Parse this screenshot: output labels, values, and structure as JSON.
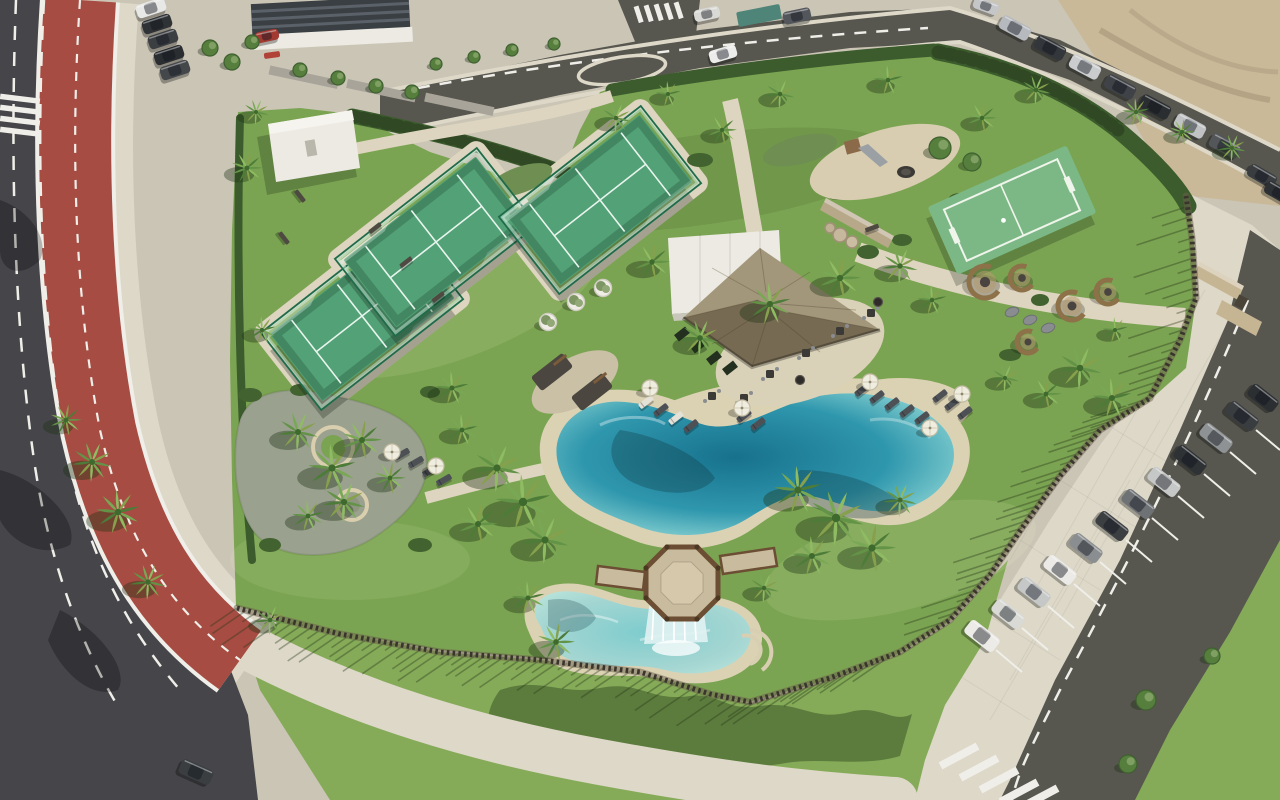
{
  "meta": {
    "kind": "aerial-photograph",
    "subject": "resort amenity park with lagoon pool, padel courts and parking",
    "width": 1280,
    "height": 800
  },
  "colors": {
    "pave": "#cbc5b6",
    "paveLight": "#ddd8c8",
    "path": "#ddd5bf",
    "asphaltDark": "#45454a",
    "asphaltMid": "#57564f",
    "bikeRed": "#a64c42",
    "laneWhite": "#efeee8",
    "grass": "#7ba452",
    "grassOuter": "#85ab58",
    "grassLight": "#a3bf6d",
    "grassDark": "#4c7034",
    "hedge": "#3c5c2d",
    "canopy": "#567f3e",
    "courtTurf": "#53a176",
    "courtWall": "#bfe2cd",
    "courtFrame": "#1f6b4a",
    "courtLine": "#e8f5ee",
    "miniTurf": "#7cb885",
    "poolDeep": "#17718d",
    "poolMid": "#2f97ad",
    "poolLight": "#7fccce",
    "poolPale": "#b7e3da",
    "kidsWater": "#a5d6d2",
    "sand": "#dbd2b4",
    "sandLot": "#c9b999",
    "thatch": "#94886b",
    "thatchDark": "#6e6450",
    "white": "#eceae2",
    "deck": "#c9bb9d",
    "wood": "#8a6c4c",
    "woodDark": "#6b4e33",
    "fencePost": "#3a352c",
    "stone": "#b7a88a",
    "wicker": "#8d7148",
    "shadow": "rgba(30,50,20,0.38)",
    "waterShadow": "rgba(15,55,65,0.32)"
  },
  "scene": {
    "palms": [
      {
        "x": 497,
        "y": 468,
        "r": 24,
        "v": 1
      },
      {
        "x": 523,
        "y": 502,
        "r": 28,
        "v": 2
      },
      {
        "x": 478,
        "y": 524,
        "r": 20,
        "v": 3
      },
      {
        "x": 545,
        "y": 540,
        "r": 24,
        "v": 1
      },
      {
        "x": 462,
        "y": 430,
        "r": 16,
        "v": 2
      },
      {
        "x": 798,
        "y": 490,
        "r": 24,
        "v": 2
      },
      {
        "x": 836,
        "y": 518,
        "r": 28,
        "v": 1
      },
      {
        "x": 872,
        "y": 548,
        "r": 24,
        "v": 3
      },
      {
        "x": 812,
        "y": 556,
        "r": 20,
        "v": 2
      },
      {
        "x": 900,
        "y": 500,
        "r": 17,
        "v": 1
      },
      {
        "x": 528,
        "y": 598,
        "r": 17,
        "v": 2
      },
      {
        "x": 556,
        "y": 642,
        "r": 19,
        "v": 3
      },
      {
        "x": 764,
        "y": 588,
        "r": 15,
        "v": 1
      },
      {
        "x": 298,
        "y": 432,
        "r": 20,
        "v": 1
      },
      {
        "x": 332,
        "y": 468,
        "r": 24,
        "v": 2
      },
      {
        "x": 362,
        "y": 440,
        "r": 20,
        "v": 3
      },
      {
        "x": 344,
        "y": 502,
        "r": 21,
        "v": 1
      },
      {
        "x": 308,
        "y": 516,
        "r": 16,
        "v": 2
      },
      {
        "x": 390,
        "y": 478,
        "r": 16,
        "v": 3
      },
      {
        "x": 92,
        "y": 462,
        "r": 20,
        "v": 1
      },
      {
        "x": 118,
        "y": 512,
        "r": 22,
        "v": 2
      },
      {
        "x": 66,
        "y": 420,
        "r": 16,
        "v": 3
      },
      {
        "x": 148,
        "y": 582,
        "r": 18,
        "v": 1
      },
      {
        "x": 262,
        "y": 330,
        "r": 14,
        "v": 2
      },
      {
        "x": 270,
        "y": 620,
        "r": 15,
        "v": 1
      },
      {
        "x": 247,
        "y": 168,
        "r": 16,
        "v": 3
      },
      {
        "x": 256,
        "y": 112,
        "r": 13,
        "v": 1
      },
      {
        "x": 452,
        "y": 388,
        "r": 17,
        "v": 2
      },
      {
        "x": 700,
        "y": 338,
        "r": 19,
        "v": 1
      },
      {
        "x": 770,
        "y": 304,
        "r": 21,
        "v": 2
      },
      {
        "x": 840,
        "y": 278,
        "r": 21,
        "v": 3
      },
      {
        "x": 900,
        "y": 266,
        "r": 18,
        "v": 1
      },
      {
        "x": 932,
        "y": 300,
        "r": 15,
        "v": 2
      },
      {
        "x": 652,
        "y": 262,
        "r": 18,
        "v": 3
      },
      {
        "x": 616,
        "y": 118,
        "r": 15,
        "v": 1
      },
      {
        "x": 668,
        "y": 94,
        "r": 13,
        "v": 2
      },
      {
        "x": 722,
        "y": 130,
        "r": 15,
        "v": 3
      },
      {
        "x": 780,
        "y": 94,
        "r": 15,
        "v": 1
      },
      {
        "x": 888,
        "y": 80,
        "r": 15,
        "v": 2
      },
      {
        "x": 982,
        "y": 118,
        "r": 15,
        "v": 3
      },
      {
        "x": 1036,
        "y": 90,
        "r": 15,
        "v": 1
      },
      {
        "x": 1136,
        "y": 112,
        "r": 14,
        "v": 2
      },
      {
        "x": 1182,
        "y": 132,
        "r": 13,
        "v": 3
      },
      {
        "x": 1232,
        "y": 148,
        "r": 14,
        "v": 1
      },
      {
        "x": 1080,
        "y": 368,
        "r": 22,
        "v": 1
      },
      {
        "x": 1112,
        "y": 398,
        "r": 20,
        "v": 2
      },
      {
        "x": 1046,
        "y": 394,
        "r": 16,
        "v": 3
      },
      {
        "x": 1005,
        "y": 378,
        "r": 14,
        "v": 1
      },
      {
        "x": 1115,
        "y": 330,
        "r": 13,
        "v": 2
      }
    ],
    "trees": [
      {
        "x": 210,
        "y": 48,
        "r": 8
      },
      {
        "x": 232,
        "y": 62,
        "r": 8
      },
      {
        "x": 252,
        "y": 42,
        "r": 7
      },
      {
        "x": 300,
        "y": 70,
        "r": 7
      },
      {
        "x": 338,
        "y": 78,
        "r": 7
      },
      {
        "x": 376,
        "y": 86,
        "r": 7
      },
      {
        "x": 412,
        "y": 92,
        "r": 7
      },
      {
        "x": 436,
        "y": 64,
        "r": 6
      },
      {
        "x": 474,
        "y": 57,
        "r": 6
      },
      {
        "x": 512,
        "y": 50,
        "r": 6
      },
      {
        "x": 554,
        "y": 44,
        "r": 6
      },
      {
        "x": 940,
        "y": 148,
        "r": 11
      },
      {
        "x": 972,
        "y": 162,
        "r": 9
      },
      {
        "x": 1146,
        "y": 700,
        "r": 10
      },
      {
        "x": 1128,
        "y": 764,
        "r": 9
      },
      {
        "x": 1212,
        "y": 656,
        "r": 8
      }
    ],
    "cars": [
      {
        "x": 151,
        "y": 8,
        "a": -18,
        "c": "#e8e8e6",
        "s": 30
      },
      {
        "x": 157,
        "y": 24,
        "a": -18,
        "c": "#303336",
        "s": 30
      },
      {
        "x": 163,
        "y": 39,
        "a": -18,
        "c": "#3c3f42",
        "s": 30
      },
      {
        "x": 169,
        "y": 55,
        "a": -18,
        "c": "#2b2e31",
        "s": 30
      },
      {
        "x": 175,
        "y": 70,
        "a": -18,
        "c": "#45484b",
        "s": 30
      },
      {
        "x": 267,
        "y": 36,
        "a": -12,
        "c": "#a33a32",
        "s": 24
      },
      {
        "x": 707,
        "y": 14,
        "a": -12,
        "c": "#d9d9d6",
        "s": 26
      },
      {
        "x": 723,
        "y": 54,
        "a": -16,
        "c": "#ececea",
        "s": 28
      },
      {
        "x": 797,
        "y": 16,
        "a": -12,
        "c": "#53565a",
        "s": 28
      },
      {
        "x": 986,
        "y": 6,
        "a": 20,
        "c": "#c4c6c8",
        "s": 26
      },
      {
        "x": 1015,
        "y": 28,
        "a": 28,
        "c": "#b6b9bd",
        "s": 32
      },
      {
        "x": 1050,
        "y": 48,
        "a": 28,
        "c": "#33363a",
        "s": 32
      },
      {
        "x": 1085,
        "y": 67,
        "a": 28,
        "c": "#caccce",
        "s": 32
      },
      {
        "x": 1120,
        "y": 87,
        "a": 28,
        "c": "#3f4246",
        "s": 32
      },
      {
        "x": 1155,
        "y": 107,
        "a": 28,
        "c": "#2b2e31",
        "s": 32
      },
      {
        "x": 1190,
        "y": 126,
        "a": 28,
        "c": "#c0c2c4",
        "s": 32
      },
      {
        "x": 1225,
        "y": 146,
        "a": 28,
        "c": "#54575a",
        "s": 32
      },
      {
        "x": 1262,
        "y": 176,
        "a": 30,
        "c": "#3a3d40",
        "s": 30
      },
      {
        "x": 1279,
        "y": 193,
        "a": 30,
        "c": "#2e3134",
        "s": 30
      },
      {
        "x": 982,
        "y": 636,
        "a": 38,
        "c": "#edebe7",
        "s": 36
      },
      {
        "x": 1008,
        "y": 614,
        "a": 38,
        "c": "#d9dad6",
        "s": 34
      },
      {
        "x": 1034,
        "y": 592,
        "a": 38,
        "c": "#c6c8c8",
        "s": 34
      },
      {
        "x": 1060,
        "y": 570,
        "a": 38,
        "c": "#eceae6",
        "s": 34
      },
      {
        "x": 1086,
        "y": 548,
        "a": 38,
        "c": "#8b8e90",
        "s": 34
      },
      {
        "x": 1112,
        "y": 526,
        "a": 38,
        "c": "#3c3f42",
        "s": 34
      },
      {
        "x": 1138,
        "y": 504,
        "a": 38,
        "c": "#6f7275",
        "s": 34
      },
      {
        "x": 1164,
        "y": 482,
        "a": 38,
        "c": "#c6c7c7",
        "s": 34
      },
      {
        "x": 1190,
        "y": 460,
        "a": 38,
        "c": "#2f3235",
        "s": 34
      },
      {
        "x": 1216,
        "y": 438,
        "a": 38,
        "c": "#8f9294",
        "s": 34
      },
      {
        "x": 1242,
        "y": 416,
        "a": 38,
        "c": "#3a3d40",
        "s": 34
      },
      {
        "x": 1263,
        "y": 398,
        "a": 38,
        "c": "#2c2f32",
        "s": 32
      },
      {
        "x": 196,
        "y": 772,
        "a": 24,
        "c": "#3a3e41",
        "s": 34
      }
    ],
    "loungers": [
      {
        "x": 646,
        "y": 402,
        "a": -38,
        "c": "#e4e1d6"
      },
      {
        "x": 661,
        "y": 410,
        "a": -38,
        "c": "#4d5156"
      },
      {
        "x": 676,
        "y": 418,
        "a": -38,
        "c": "#e4e1d6"
      },
      {
        "x": 691,
        "y": 426,
        "a": -38,
        "c": "#4d5156"
      },
      {
        "x": 744,
        "y": 416,
        "a": -38,
        "c": "#4d5156"
      },
      {
        "x": 758,
        "y": 424,
        "a": -38,
        "c": "#4d5156"
      },
      {
        "x": 862,
        "y": 390,
        "a": -38,
        "c": "#4d5156"
      },
      {
        "x": 877,
        "y": 397,
        "a": -38,
        "c": "#4d5156"
      },
      {
        "x": 892,
        "y": 404,
        "a": -38,
        "c": "#4d5156"
      },
      {
        "x": 907,
        "y": 411,
        "a": -38,
        "c": "#4d5156"
      },
      {
        "x": 922,
        "y": 418,
        "a": -38,
        "c": "#4d5156"
      },
      {
        "x": 952,
        "y": 404,
        "a": -38,
        "c": "#4d5156"
      },
      {
        "x": 965,
        "y": 413,
        "a": -38,
        "c": "#4d5156"
      },
      {
        "x": 940,
        "y": 396,
        "a": -38,
        "c": "#4d5156"
      },
      {
        "x": 402,
        "y": 454,
        "a": -30,
        "c": "#4d5156"
      },
      {
        "x": 416,
        "y": 462,
        "a": -30,
        "c": "#4d5156"
      },
      {
        "x": 430,
        "y": 471,
        "a": -30,
        "c": "#4d5156"
      },
      {
        "x": 444,
        "y": 480,
        "a": -30,
        "c": "#4d5156"
      }
    ],
    "umbrellas": [
      {
        "x": 650,
        "y": 388
      },
      {
        "x": 742,
        "y": 408
      },
      {
        "x": 870,
        "y": 382
      },
      {
        "x": 930,
        "y": 428
      },
      {
        "x": 392,
        "y": 452
      },
      {
        "x": 436,
        "y": 466
      },
      {
        "x": 962,
        "y": 394
      }
    ],
    "pods": [
      {
        "x": 985,
        "y": 282,
        "r": 16
      },
      {
        "x": 1022,
        "y": 278,
        "r": 12
      },
      {
        "x": 1072,
        "y": 306,
        "r": 14
      },
      {
        "x": 1028,
        "y": 342,
        "r": 11
      },
      {
        "x": 1108,
        "y": 292,
        "r": 12
      }
    ],
    "beanbags": [
      {
        "x": 1012,
        "y": 312
      },
      {
        "x": 1030,
        "y": 320
      },
      {
        "x": 1048,
        "y": 328
      }
    ],
    "planters": [
      {
        "x": 548,
        "y": 322
      },
      {
        "x": 576,
        "y": 302
      },
      {
        "x": 603,
        "y": 288
      }
    ],
    "benches": [
      {
        "x": 375,
        "y": 228,
        "a": -38
      },
      {
        "x": 406,
        "y": 262,
        "a": -38
      },
      {
        "x": 438,
        "y": 297,
        "a": -38
      },
      {
        "x": 300,
        "y": 196,
        "a": 52
      },
      {
        "x": 284,
        "y": 238,
        "a": 52
      },
      {
        "x": 872,
        "y": 228,
        "a": -20
      }
    ],
    "tables": [
      {
        "x": 770,
        "y": 374
      },
      {
        "x": 806,
        "y": 353
      },
      {
        "x": 840,
        "y": 331
      },
      {
        "x": 871,
        "y": 313
      },
      {
        "x": 744,
        "y": 398
      },
      {
        "x": 712,
        "y": 396
      }
    ],
    "firebowls": [
      {
        "x": 878,
        "y": 302
      },
      {
        "x": 800,
        "y": 380
      }
    ],
    "fence": {
      "points": [
        [
          237,
          608
        ],
        [
          340,
          634
        ],
        [
          440,
          652
        ],
        [
          540,
          660
        ],
        [
          640,
          672
        ],
        [
          710,
          694
        ],
        [
          750,
          702
        ],
        [
          830,
          678
        ],
        [
          900,
          652
        ],
        [
          950,
          620
        ],
        [
          990,
          575
        ],
        [
          1022,
          528
        ],
        [
          1060,
          476
        ],
        [
          1100,
          430
        ],
        [
          1150,
          398
        ],
        [
          1180,
          340
        ],
        [
          1196,
          298
        ],
        [
          1192,
          238
        ],
        [
          1186,
          196
        ]
      ],
      "shadow_bottom": {
        "from": 0,
        "to": 8,
        "dx": -38,
        "dy": 26
      },
      "shadow_right": {
        "from": 9,
        "to": 18,
        "dx": -52,
        "dy": 17
      }
    },
    "padel_courts": [
      {
        "cx": 362,
        "cy": 316,
        "a": -38
      },
      {
        "cx": 436,
        "cy": 242,
        "a": -38
      },
      {
        "cx": 600,
        "cy": 200,
        "a": -38
      }
    ],
    "mini_court": {
      "cx": 1012,
      "cy": 210,
      "a": -24
    },
    "counts": {
      "padel_courts": 3,
      "mini_courts": 1,
      "pools": 2,
      "parked_cars_right_row": 12
    }
  }
}
